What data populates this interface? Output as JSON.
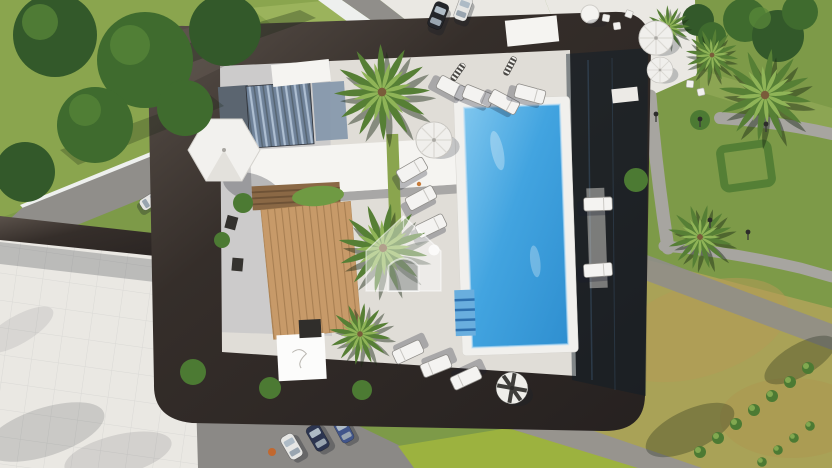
{
  "scene": {
    "type": "aerial-architectural-render",
    "description": "Top-down aerial 3D rendering of a modern luxury villa: a dark flat roof frames a central courtyard with palm trees, glass louvre roofs, a wooden deck with a white dining table, and a rectangular bright blue swimming pool surrounded by white sun loungers and parasols. Landscaped gardens with winding grey paths, lamp posts, hedges and lawns surround the house; cars are parked on the street at the top and on the driveway at the bottom. A translucent house-shaped logo is watermarked at the centre.",
    "watermark": "translucent house logo"
  },
  "colors": {
    "roof_dark": "#352e2a",
    "roof_light": "#5b524b",
    "terrace_white": "#eae8e3",
    "coping_white": "#f1f0ed",
    "pool_blue": "#42a4e0",
    "pool_deep": "#2f8fd0",
    "pool_light": "#7fc6ee",
    "pool_steps": "#2d6fae",
    "deck_wood": "#c79a69",
    "deck_line": "#a87f52",
    "pergola_wood": "#8a6845",
    "glass_blue": "#6f8299",
    "glass_light": "#aebfd2",
    "grass_green": "#8aa54e",
    "garden_green": "#7d9a48",
    "lawn_yellow": "#a9a257",
    "lime_lawn": "#9cb23f",
    "hedge_dark": "#4c7a33",
    "palm_green": "#567f35",
    "palm_light": "#8fb457",
    "road_gray": "#908e8a",
    "path_gray": "#a7a5a0",
    "car_white": "#e6e6e4",
    "car_dark": "#23252a",
    "car_navy": "#2c3550",
    "car_blue": "#41558a",
    "shadow": "rgba(25,30,40,0.28)"
  },
  "objects": {
    "swimming_pool": 1,
    "pool_steps": 1,
    "sun_loungers": 12,
    "parasols": 7,
    "palm_trees": 7,
    "wood_deck": 1,
    "pergola": 1,
    "glass_louvre_roof": 1,
    "dining_table": 1,
    "cars_street": 2,
    "cars_driveway": 3,
    "cars_garage": 1,
    "lamp_posts": 5,
    "garden_paths": 3,
    "watermark_logo": 1
  }
}
